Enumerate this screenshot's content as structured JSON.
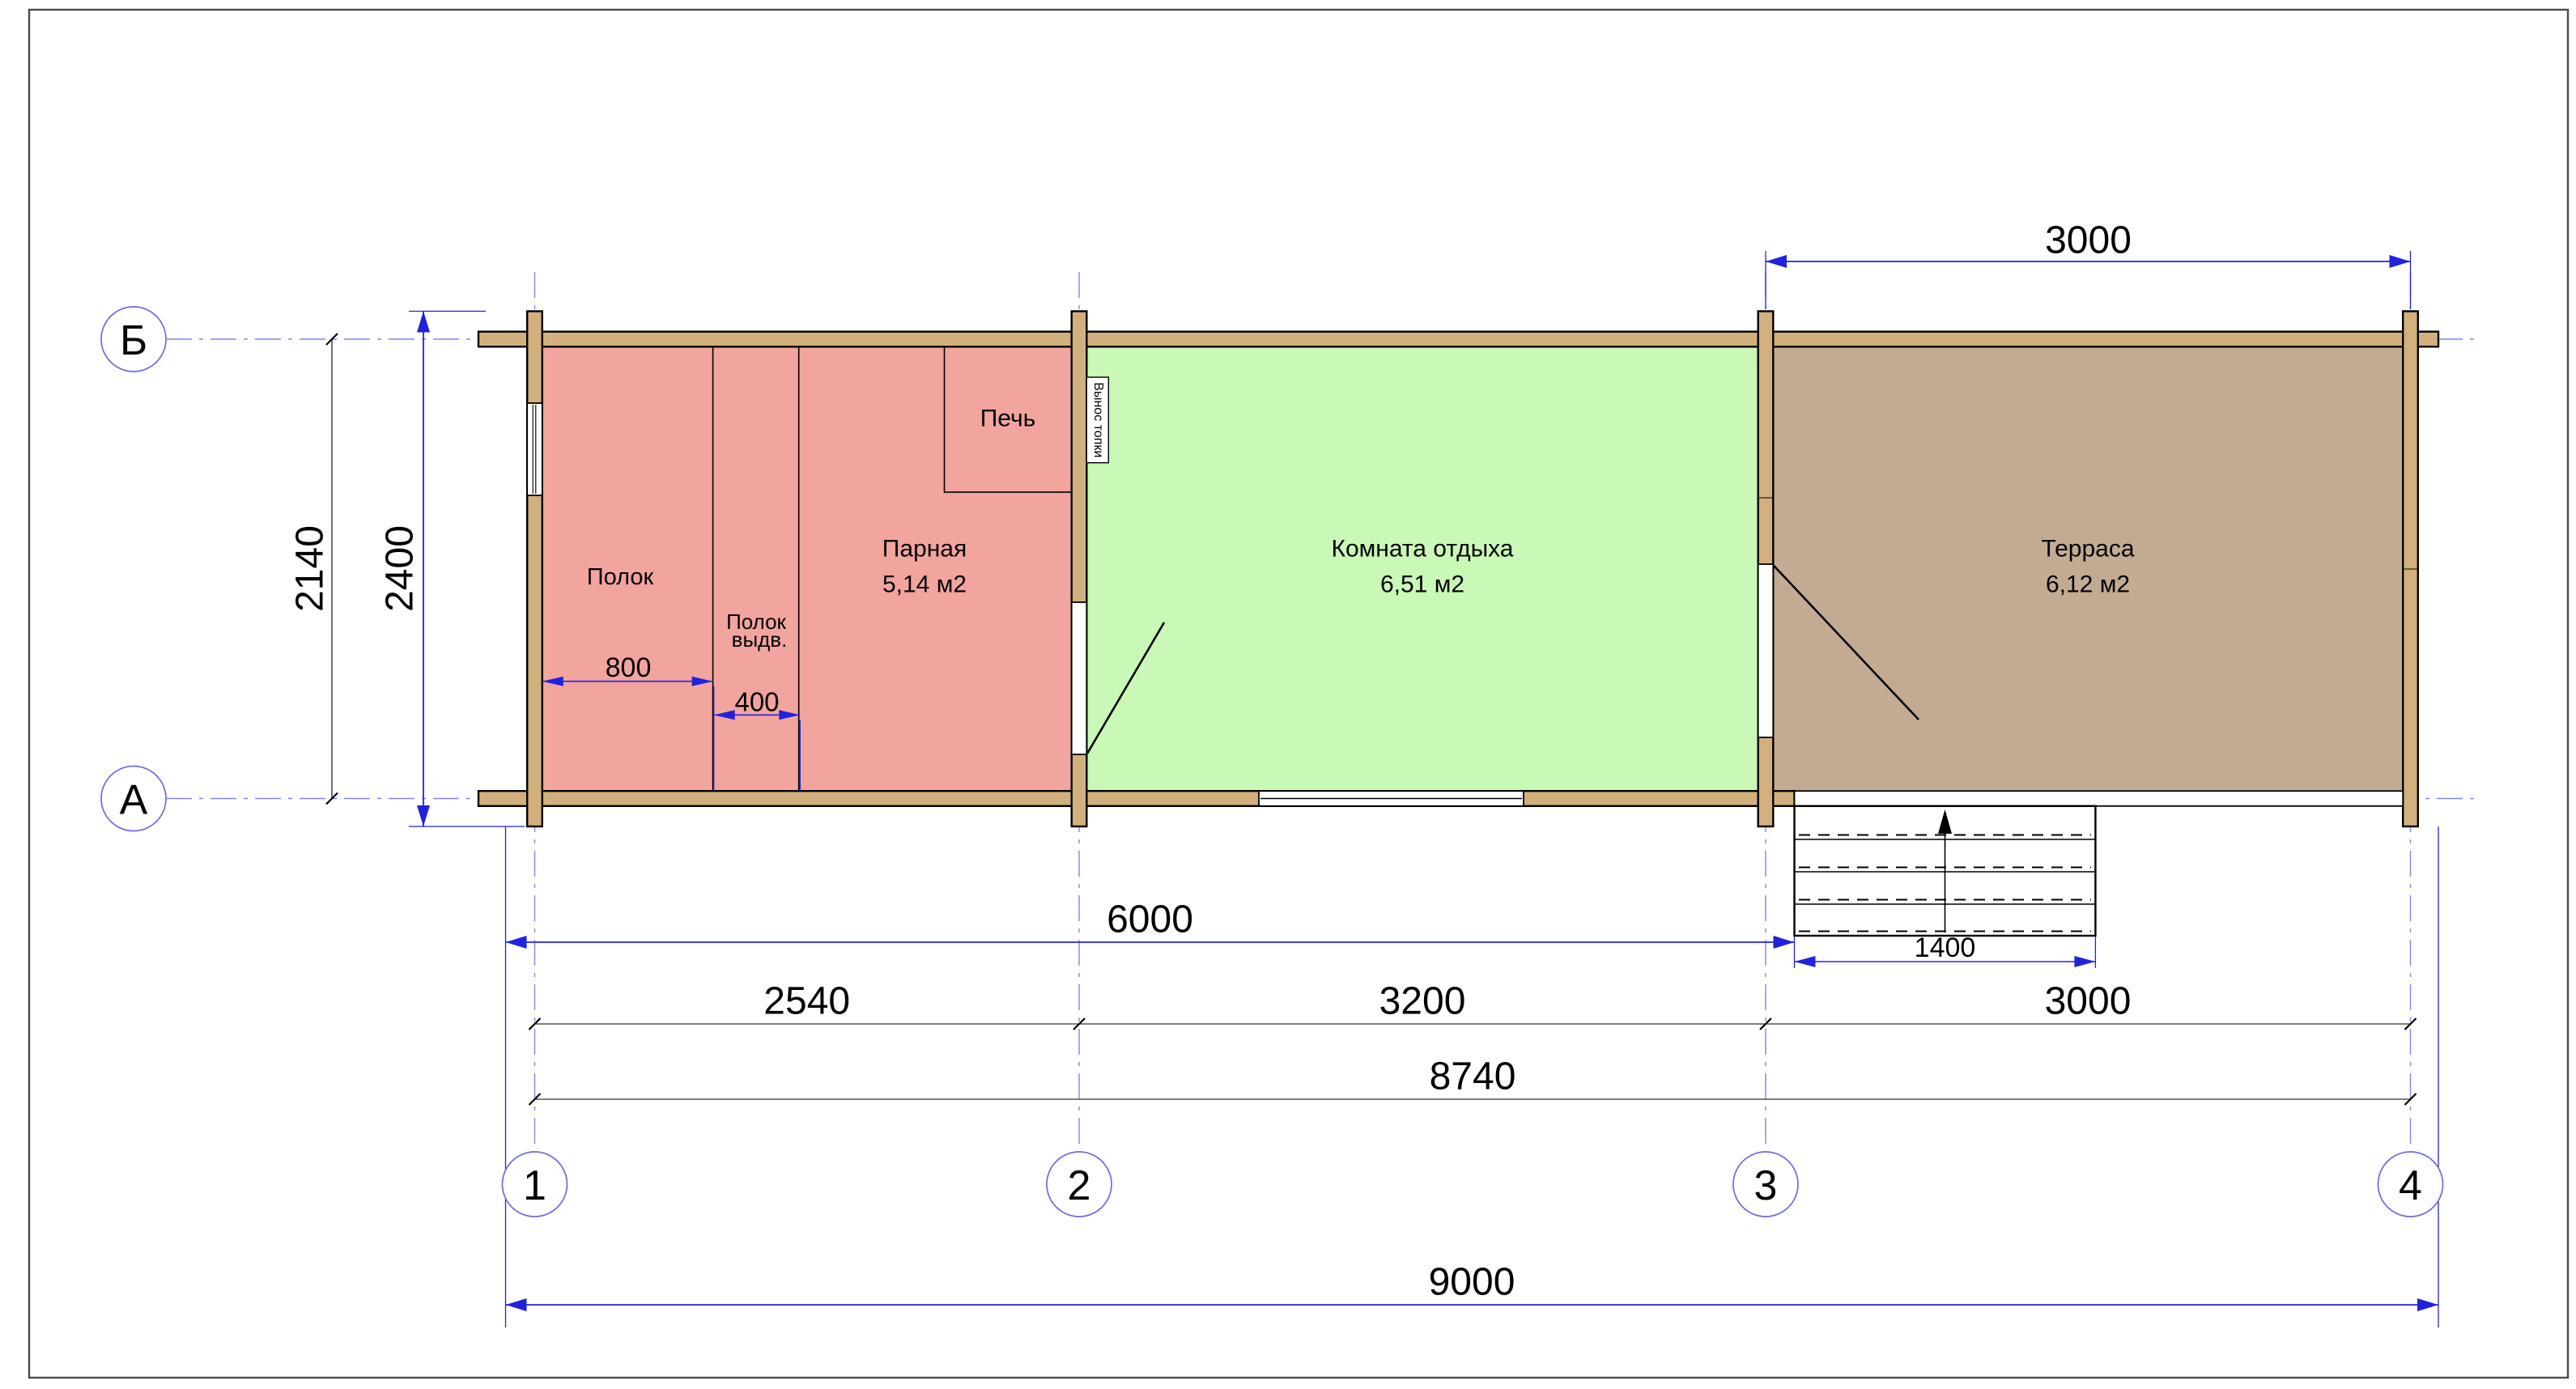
{
  "drawing_title": "План бани (floor plan)",
  "axes": {
    "rows": [
      {
        "label": "Б"
      },
      {
        "label": "А"
      }
    ],
    "cols": [
      {
        "label": "1"
      },
      {
        "label": "2"
      },
      {
        "label": "3"
      },
      {
        "label": "4"
      }
    ]
  },
  "rooms": [
    {
      "name": "Парная",
      "area": "5,14 м2"
    },
    {
      "name": "Комната отдыха",
      "area": "6,51 м2"
    },
    {
      "name": "Терраса",
      "area": "6,12 м2"
    }
  ],
  "labels": {
    "shelf": "Полок",
    "shelf_pullout_line1": "Полок",
    "shelf_pullout_line2": "выдв.",
    "stove": "Печь",
    "furnace_extension": "Вынос топки"
  },
  "dimensions": {
    "terrace_top": "3000",
    "axes_height": "2140",
    "overall_height": "2400",
    "shelf_width": "800",
    "shelf_pullout_width": "400",
    "main_block_length": "6000",
    "span_1_2": "2540",
    "span_2_3": "3200",
    "span_3_4": "3000",
    "axes_length": "8740",
    "overall_length": "9000",
    "stairs_width": "1400"
  },
  "colors": {
    "steam_room": "#F2A49E",
    "rest_room": "#C9F8B7",
    "terrace": "#C3AB93",
    "wood_wall": "#D2B07E",
    "dim_blue": "#2222DD",
    "axis_blue": "#8383F0",
    "bubble_blue": "#6B6BE8",
    "frame_gray": "#4A4A4A",
    "white": "#FFFFFF"
  }
}
